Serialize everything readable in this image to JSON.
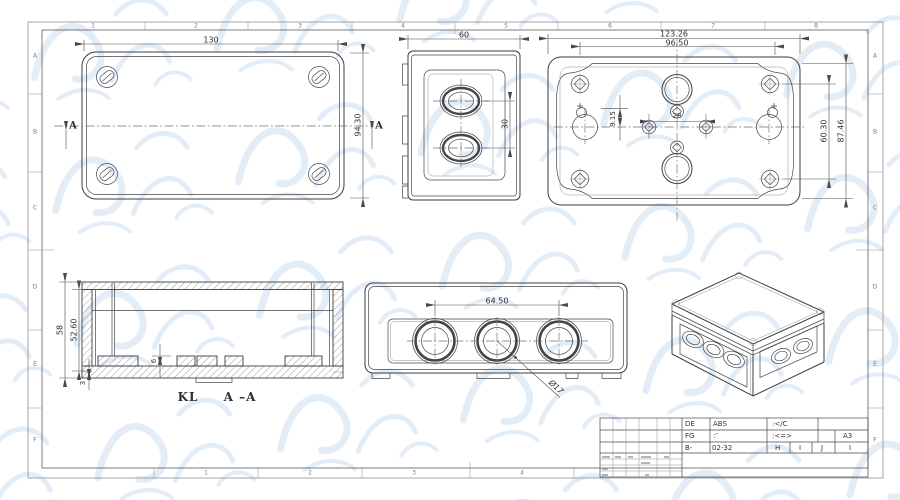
{
  "colors": {
    "line": "#3d3d3d",
    "watermark": "#d9e8f7"
  },
  "frame": {
    "zones_top": [
      "1",
      "2",
      "3",
      "4",
      "5",
      "6",
      "7",
      "8"
    ],
    "zones_bottom": [
      "1",
      "2",
      "3",
      "4"
    ],
    "zones_left": [
      "A",
      "B",
      "C",
      "D",
      "E",
      "F"
    ],
    "zones_right": [
      "A",
      "B",
      "C",
      "D",
      "E",
      "F"
    ]
  },
  "views": {
    "top": {
      "dim_width": "130",
      "dim_height": "94.30",
      "section_marker": "A"
    },
    "side": {
      "dim_width": "60",
      "dim_hole_pitch": "30"
    },
    "bottom": {
      "dim_overall_width": "123.26",
      "dim_screw_span": "96.50",
      "dim_center_pitch": "28",
      "dim_offset": "9.15",
      "dim_span_inner": "60.30",
      "dim_span_outer": "87.46"
    },
    "section": {
      "dim_height": "58",
      "dim_inner_height": "52.60",
      "dim_boss_height": "6",
      "dim_base": "3",
      "label_prefix": "KL",
      "label_section": "A –A"
    },
    "front": {
      "dim_hole_pitch": "64.50",
      "dim_hole_dia": "Ø17"
    }
  },
  "title_block": {
    "col1": [
      "DE",
      "FG",
      "B-"
    ],
    "col2": [
      "ABS",
      ":″",
      "02-32"
    ],
    "col3": [
      ":</C",
      ":<=>"
    ],
    "size": "A3",
    "zone_cells": [
      "H",
      "I",
      "J",
      "I"
    ]
  }
}
